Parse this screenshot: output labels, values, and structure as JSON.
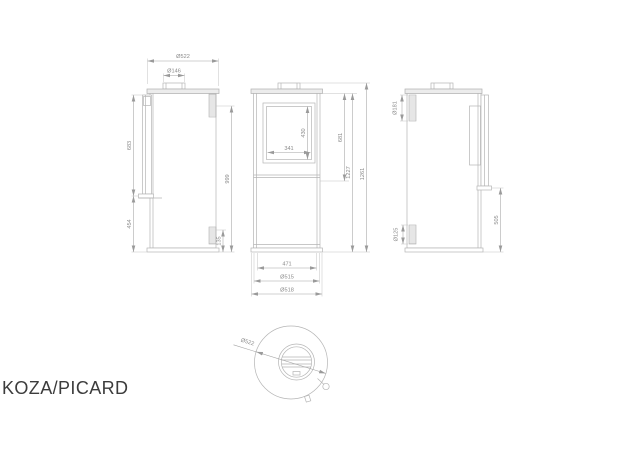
{
  "title": "KOZA/PICARD",
  "drawing_type": "stove technical dimension drawing",
  "views": {
    "side_left": {
      "label": "left side view",
      "dims": {
        "top_width": "Ø522",
        "flue_collar": "Ø146",
        "upper": "683",
        "lower": "454",
        "right": "999",
        "base": "135"
      }
    },
    "front": {
      "label": "front view",
      "dims": {
        "glass_h": "430",
        "glass_w": "341",
        "door": "681",
        "body": "1227",
        "total": "1261",
        "legs": "471",
        "base_inner": "Ø515",
        "base_outer": "Ø518"
      }
    },
    "side_right": {
      "label": "right side view",
      "dims": {
        "flue": "Ø181",
        "inlet": "Ø125",
        "shelf": "505"
      }
    },
    "top": {
      "label": "top view",
      "dims": {
        "diameter": "Ø522"
      }
    }
  },
  "colors": {
    "line": "#b5b5b5",
    "dim_line": "#a3a3a3",
    "dim_text": "#8a8a8a",
    "title_text": "#3c3c3c",
    "background": "#ffffff"
  }
}
